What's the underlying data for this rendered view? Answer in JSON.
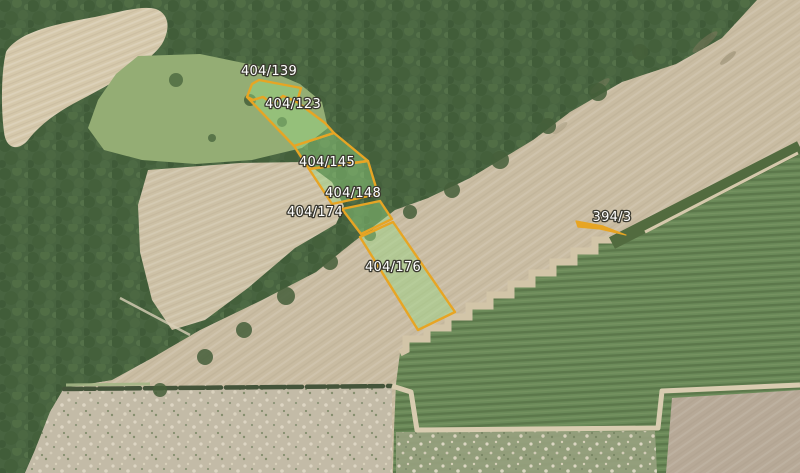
{
  "map": {
    "description": "aerial orthophoto with highlighted cadastral parcels",
    "colors": {
      "parcel_stroke": "#E7A524",
      "parcel_fill": "rgba(150,215,130,0.45)",
      "label_text": "#FFFFFF",
      "label_halo": "#3A392F",
      "forest": "#486440",
      "field_tan": "#C9BCA2",
      "crop_green": "#6B8A59",
      "meadow_green": "#94AD74",
      "path_tan": "#D8CCB0"
    },
    "parcels": [
      {
        "id": "404/139",
        "points": "247,97 252,84 259,80 301,88 297,102 283,96 273,104 263,97 253,100"
      },
      {
        "id": "404/123",
        "points": "247,97 253,100 263,97 273,104 283,96 297,102 325,123 334,133 294,146"
      },
      {
        "id": "404/145",
        "points": "294,146 334,133 368,161 309,169"
      },
      {
        "id": "404/148",
        "points": "309,169 368,161 378,194 332,204"
      },
      {
        "id": "404/174",
        "points": "342,209 380,201 392,219 361,234"
      },
      {
        "id": "404/176",
        "points": "360,237 393,222 455,312 418,330"
      },
      {
        "id": "394/3",
        "points": "576,221 603,226 626,235 600,229 578,227"
      }
    ]
  }
}
